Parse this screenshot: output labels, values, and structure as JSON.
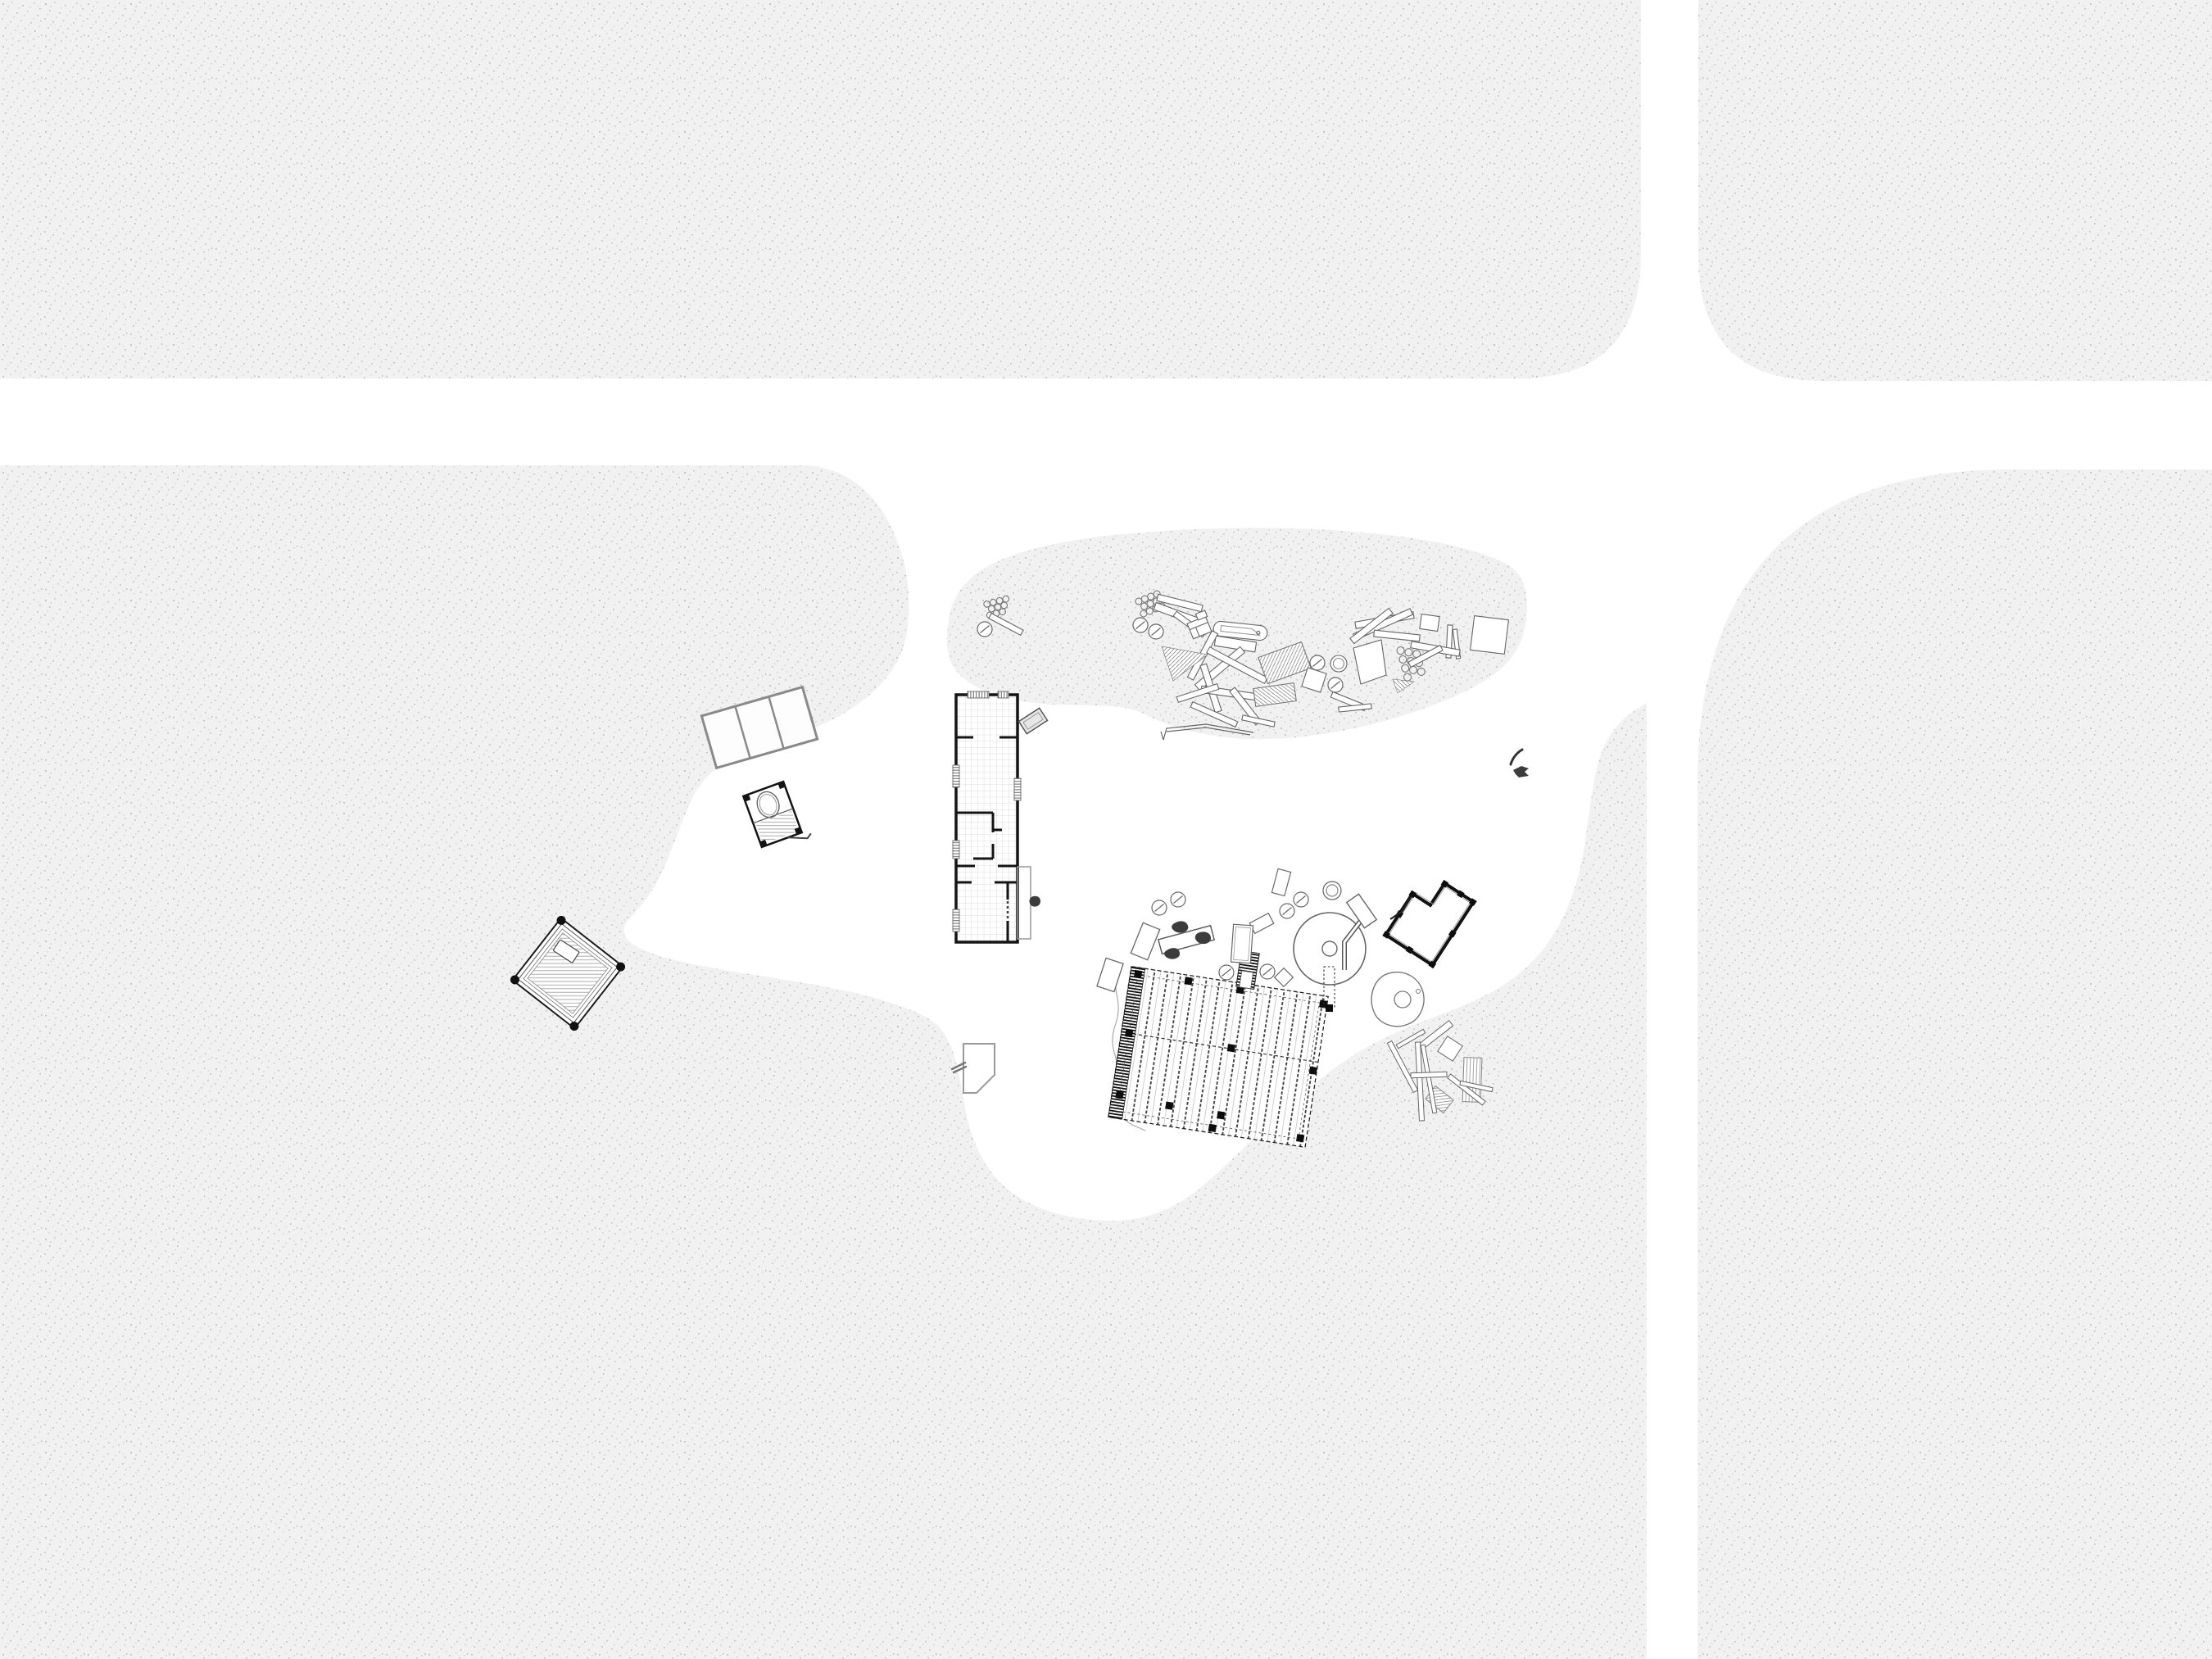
{
  "scene": {
    "label": "Architectural site plan drawing with vegetation blocks, crossing paths, a central clearing, cabin floor plans, a deck framing plan and piles of building materials",
    "type": "site-plan",
    "visible_text": []
  },
  "colors": {
    "background": "#ffffff",
    "ground_block": "#f1f1f1",
    "stipple_dark": "#c6c6c6",
    "stipple_light": "#d9d9d9",
    "wall_ink": "#141414",
    "line_medium": "#555555",
    "line_light": "#9a9a9a",
    "figure_dark": "#3c3c3c"
  },
  "objects": [
    {
      "name": "vegetation-block-top-left",
      "kind": "stippled ground block with rounded corner"
    },
    {
      "name": "vegetation-block-top-right",
      "kind": "stippled ground block with rounded corner"
    },
    {
      "name": "vegetation-block-right",
      "kind": "stippled ground block with large rounded corner"
    },
    {
      "name": "vegetation-landmass-left",
      "kind": "large stippled ground block with organic clearing"
    },
    {
      "name": "vegetation-island-north",
      "kind": "organic stippled patch holding material pile"
    },
    {
      "name": "road-horizontal",
      "kind": "white path"
    },
    {
      "name": "road-vertical",
      "kind": "white path"
    },
    {
      "name": "cabin-floorplan",
      "kind": "long rectangular building plan with tiled floor, walls, windows and rooms"
    },
    {
      "name": "cabin-porch",
      "kind": "thin outlined porch rectangle"
    },
    {
      "name": "cabin-doormat",
      "kind": "small tilted rectangle"
    },
    {
      "name": "panel-table",
      "kind": "three-panel tilted rectangle"
    },
    {
      "name": "outhouse-plan",
      "kind": "small tilted hut plan with barrel and hatched floor"
    },
    {
      "name": "platform-plan",
      "kind": "tilted square platform with nested borders, hatching and corner posts"
    },
    {
      "name": "paper-shed",
      "kind": "small clipped-corner outline with hook"
    },
    {
      "name": "deck-framing-plan",
      "kind": "large tilted deck with dashed joists, comb edge band and post squares"
    },
    {
      "name": "deck-stair",
      "kind": "small hatched stair rectangle"
    },
    {
      "name": "round-pavilion-plan",
      "kind": "large circle with centre post, bent wall and scattered furniture"
    },
    {
      "name": "boulder",
      "kind": "irregular stone outline"
    },
    {
      "name": "bench-with-figures",
      "kind": "tilted bench with dark human figures"
    },
    {
      "name": "l-shaped-cabin-plan",
      "kind": "tilted notched rectangle plan with thick walls and posts"
    },
    {
      "name": "materials-pile-north",
      "kind": "scattered planks, hatched panels, honeycomb bundles and log rounds"
    },
    {
      "name": "materials-pile-south",
      "kind": "scattered planks and hatched panels"
    },
    {
      "name": "ground-marks",
      "kind": "small dark strokes"
    }
  ]
}
